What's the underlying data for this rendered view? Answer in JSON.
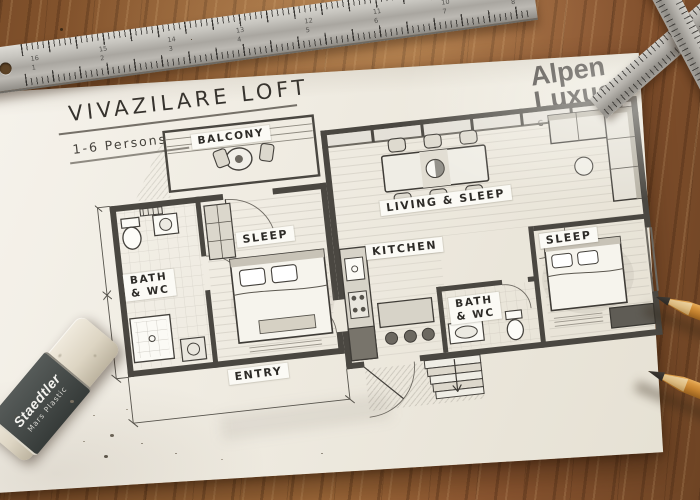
{
  "title": {
    "text": "VIVAZILARE LOFT",
    "subtitle": "1-6 Persons"
  },
  "brand": {
    "name_line1": "Alpen",
    "name_line2": "Luxus",
    "tagline": "COLLECTION"
  },
  "plan": {
    "rooms": {
      "balcony": "BALCONY",
      "sleep_left": "SLEEP",
      "bath_left": "BATH\n& WC",
      "living": "LIVING & SLEEP",
      "kitchen": "KITCHEN",
      "bath_mid": "BATH\n& WC",
      "sleep_right": "SLEEP",
      "entry": "ENTRY"
    }
  },
  "tools": {
    "ruler": {
      "numbers_top": [
        "16",
        "15",
        "14",
        "13",
        "12",
        "11",
        "10",
        "9"
      ],
      "numbers_bottom": [
        "1",
        "2",
        "3",
        "4",
        "5",
        "6",
        "7",
        "8"
      ]
    },
    "eraser": {
      "brand": "Staedtler",
      "model": "Mars Plastic"
    }
  },
  "colors": {
    "wood": "#8a5733",
    "paper": "#efebe1",
    "ink": "#3f3d39",
    "metal": "#b4b1ab",
    "logo": "#3b3733",
    "pencil_wood": "#c8883f"
  }
}
